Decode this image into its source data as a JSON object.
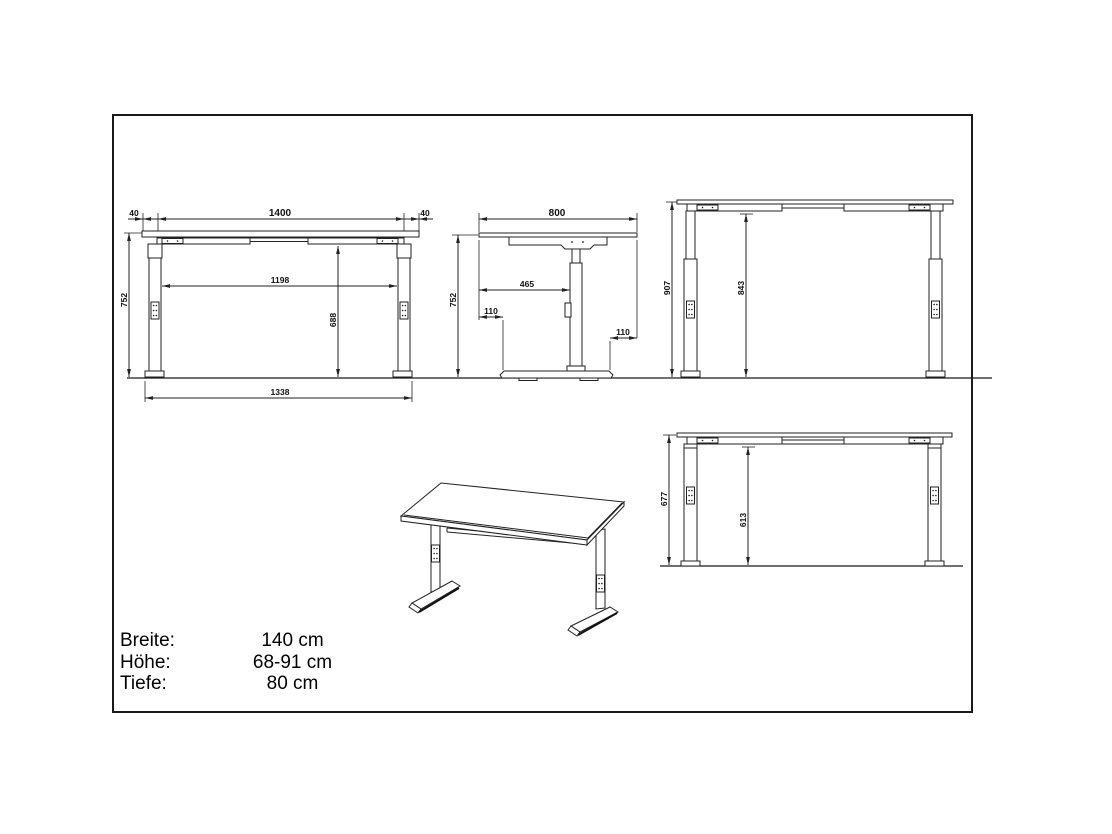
{
  "drawing": {
    "type": "technical dimension drawing",
    "subject": "height-adjustable desk",
    "units": "mm"
  },
  "views": {
    "front": {
      "name": "front view at standard height",
      "dims": {
        "top_width": "1400",
        "overhang_left": "40",
        "overhang_right": "40",
        "height": "752",
        "clearance_width": "1198",
        "clearance_height": "688",
        "foot_span": "1338"
      }
    },
    "side": {
      "name": "side view",
      "dims": {
        "depth": "800",
        "height": "752",
        "edge_to_column": "465",
        "front_overhang": "110",
        "rear_overhang": "110"
      }
    },
    "front_raised": {
      "name": "front view raised",
      "dims": {
        "height": "907",
        "clearance_height": "843"
      }
    },
    "front_lowered": {
      "name": "front view lowered",
      "dims": {
        "height": "677",
        "clearance_height": "613"
      }
    }
  },
  "specs": {
    "rows": [
      {
        "label": "Breite:",
        "value": "140 cm"
      },
      {
        "label": "Höhe:",
        "value": "68-91 cm"
      },
      {
        "label": "Tiefe:",
        "value": "80 cm"
      }
    ]
  },
  "colors": {
    "line": "#222222",
    "text": "#111111",
    "background": "#ffffff"
  }
}
